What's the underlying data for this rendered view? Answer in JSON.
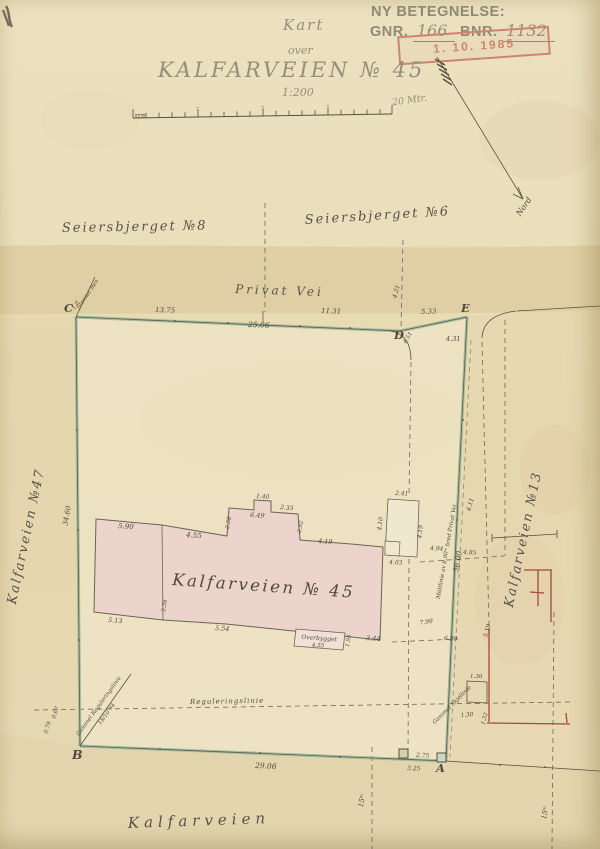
{
  "header": {
    "ny_betegnelse": "NY BETEGNELSE:",
    "gnr_label": "GNR.",
    "gnr_value": "166",
    "bnr_label": "BNR.",
    "bnr_value": "1132",
    "stamp_date": "1. 10. 1985",
    "title_small": "Kart",
    "title_over": "over",
    "title_main": "KALFARVEIEN  № 45",
    "scale_ratio": "1:200",
    "scale_unit": "20 Mtr."
  },
  "north": {
    "label": "Nord"
  },
  "streets": {
    "privat_vei": "Privat Vei",
    "seiersbjerget8": "Seiersbjerget №8",
    "seiersbjerget6": "Seiersbjerget №6",
    "kalfarveien47": "Kalfarveien №47",
    "kalfarveien13": "Kalfarveien №13",
    "kalfarveien_bottom": "Kalfarveien"
  },
  "parcel": {
    "label": "Kalfarveien  № 45",
    "overbygget": "Overbygget",
    "overbygget_dim": "4.55"
  },
  "points": {
    "a": "A",
    "b": "B",
    "c": "C",
    "d": "D",
    "e": "E"
  },
  "dims": {
    "top1": "13.75",
    "top_total": "25.06",
    "top2": "11.31",
    "de": "5.33",
    "e_s": "4.31",
    "d_s": "4.51",
    "d_n": "4.21",
    "e_e": "4.11",
    "west": "34.60",
    "south": "29.06",
    "a_n": "2.75",
    "a_s": "3.25",
    "mid": "36.00",
    "r_494": "4.94",
    "r_485": "4.85",
    "r_799": "7.99",
    "r_690": "6.90",
    "r_519": "5.19",
    "annex_n": "2.41",
    "annex_w": "4.10",
    "annex_e": "4.19",
    "annex_s": "4.03",
    "b_590": "5.90",
    "b_455": "4.55",
    "b_140": "1.40",
    "b_649": "6.49",
    "b_233": "2.33",
    "b_258": "2.58",
    "b_292": "2.92",
    "b_419": "4.19",
    "b_513": "5.13",
    "b_554": "5.54",
    "b_344": "3.44",
    "b_195": "1.95",
    "b_338": "3.38",
    "step_130a": "1.30",
    "step_130b": "1.30",
    "step_132": "1.32",
    "b_079": "0.79",
    "b_067": "0.67",
    "c_10": "1.0"
  },
  "annotations": {
    "midtlinie": "Midtlinie av 8.00ᵐ bred Privat Vei",
    "regulering": "Reguleringslinie",
    "gammel_reg": "Gammel Reguleringslinie",
    "gammel_reg_date": "18/10 94",
    "stensat": "Stensat Ren",
    "gammel_skjel": "Gammel Skjellinie",
    "m15_a": "15ᵐ",
    "m15_b": "15ᵐ"
  },
  "colors": {
    "paper": "#e8dcb6",
    "road_band": "#d9c498",
    "boundary_green": "#9cb79a",
    "building_pink": "#ecd3cc",
    "stamp_red": "#b43a2d",
    "regulation_red": "#a34a38",
    "ink": "#55503f"
  }
}
